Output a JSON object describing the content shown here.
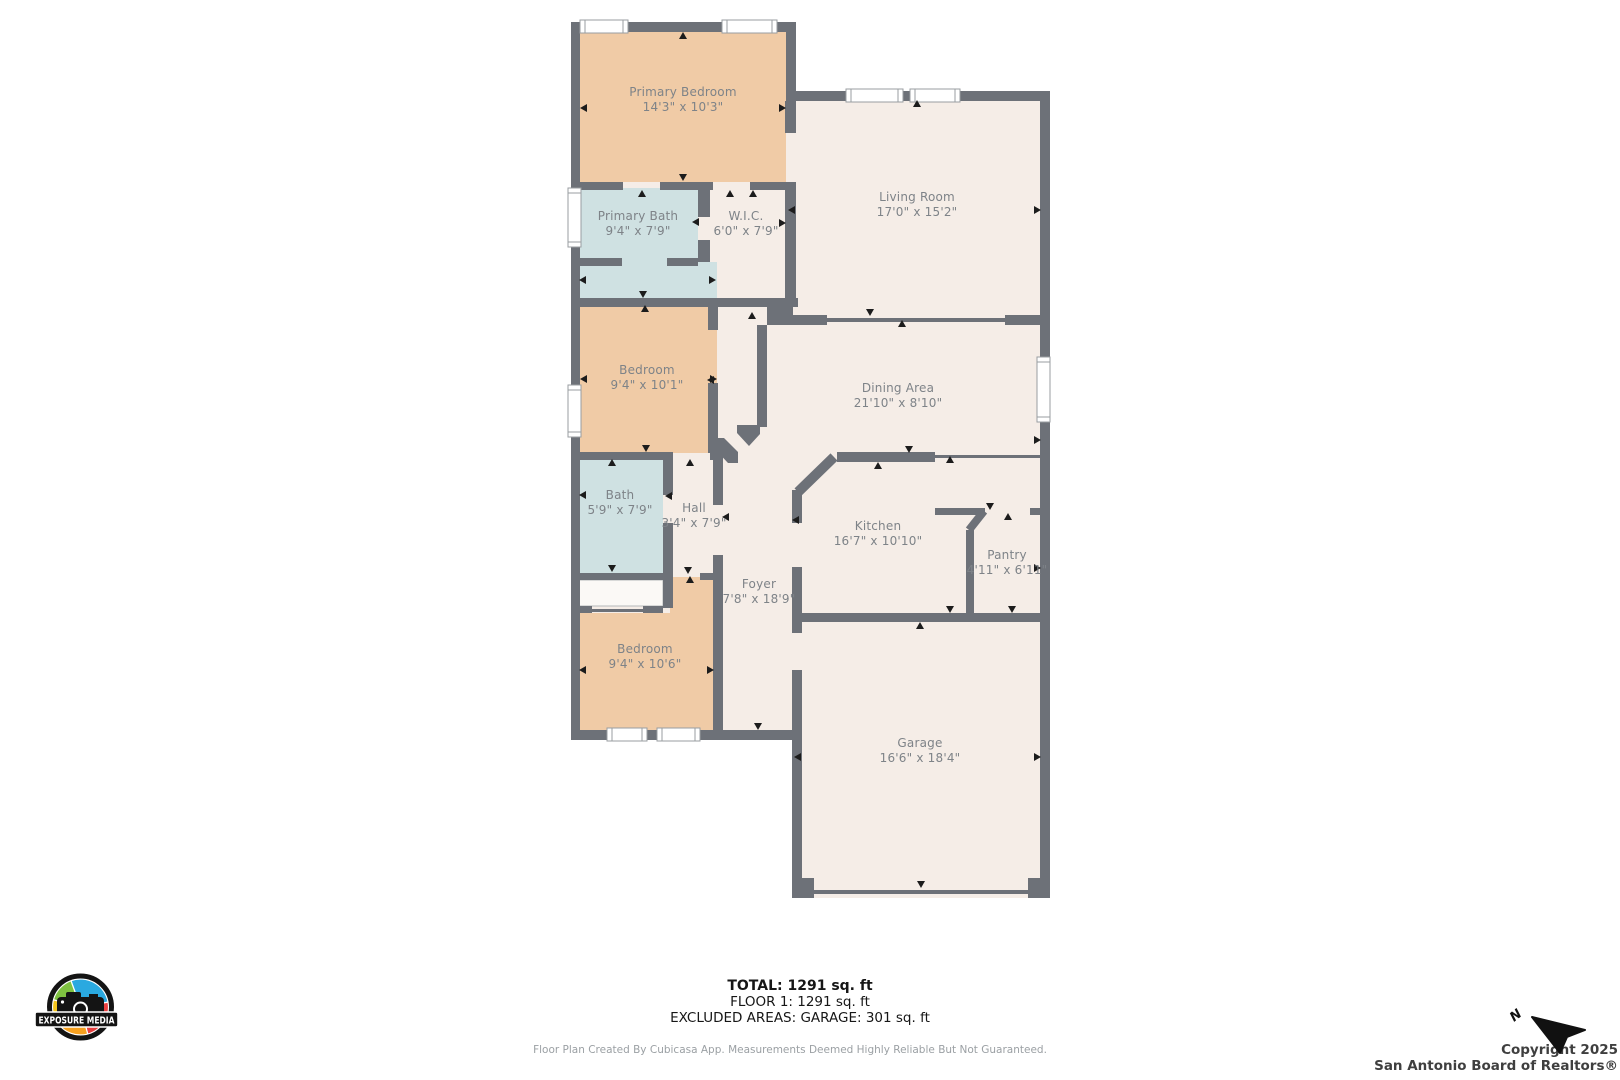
{
  "rooms": [
    {
      "name": "Primary Bedroom",
      "dims": "14'3\" x 10'3\""
    },
    {
      "name": "Living Room",
      "dims": "17'0\" x 15'2\""
    },
    {
      "name": "Primary Bath",
      "dims": "9'4\" x 7'9\""
    },
    {
      "name": "W.I.C.",
      "dims": "6'0\" x 7'9\""
    },
    {
      "name": "Bedroom",
      "dims": "9'4\" x 10'1\""
    },
    {
      "name": "Dining Area",
      "dims": "21'10\" x 8'10\""
    },
    {
      "name": "Bath",
      "dims": "5'9\" x 7'9\""
    },
    {
      "name": "Hall",
      "dims": "3'4\" x 7'9\""
    },
    {
      "name": "Kitchen",
      "dims": "16'7\" x 10'10\""
    },
    {
      "name": "Pantry",
      "dims": "4'11\" x 6'11\""
    },
    {
      "name": "Foyer",
      "dims": "7'8\" x 18'9\""
    },
    {
      "name": "Bedroom",
      "dims": "9'4\" x 10'6\""
    },
    {
      "name": "Garage",
      "dims": "16'6\" x 18'4\""
    }
  ],
  "summary": {
    "total": "TOTAL: 1291 sq. ft",
    "floor": "FLOOR 1: 1291 sq. ft",
    "excluded": "EXCLUDED AREAS: GARAGE: 301 sq. ft"
  },
  "disclaimer": "Floor Plan Created By Cubicasa App. Measurements Deemed Highly Reliable But Not Guaranteed.",
  "copyright": {
    "line1": "Copyright 2025",
    "line2": "San Antonio Board of Realtors®"
  },
  "logo": {
    "text": "EXPOSURE MEDIA"
  },
  "compass": {
    "label": "N"
  },
  "colors": {
    "wall": "#6d7178",
    "room_tan": "#f0cba6",
    "room_blue": "#cfe1e2",
    "floor_beige": "#f5ede7",
    "closet_white": "#fbf9f6",
    "label_text": "#7e8388"
  }
}
